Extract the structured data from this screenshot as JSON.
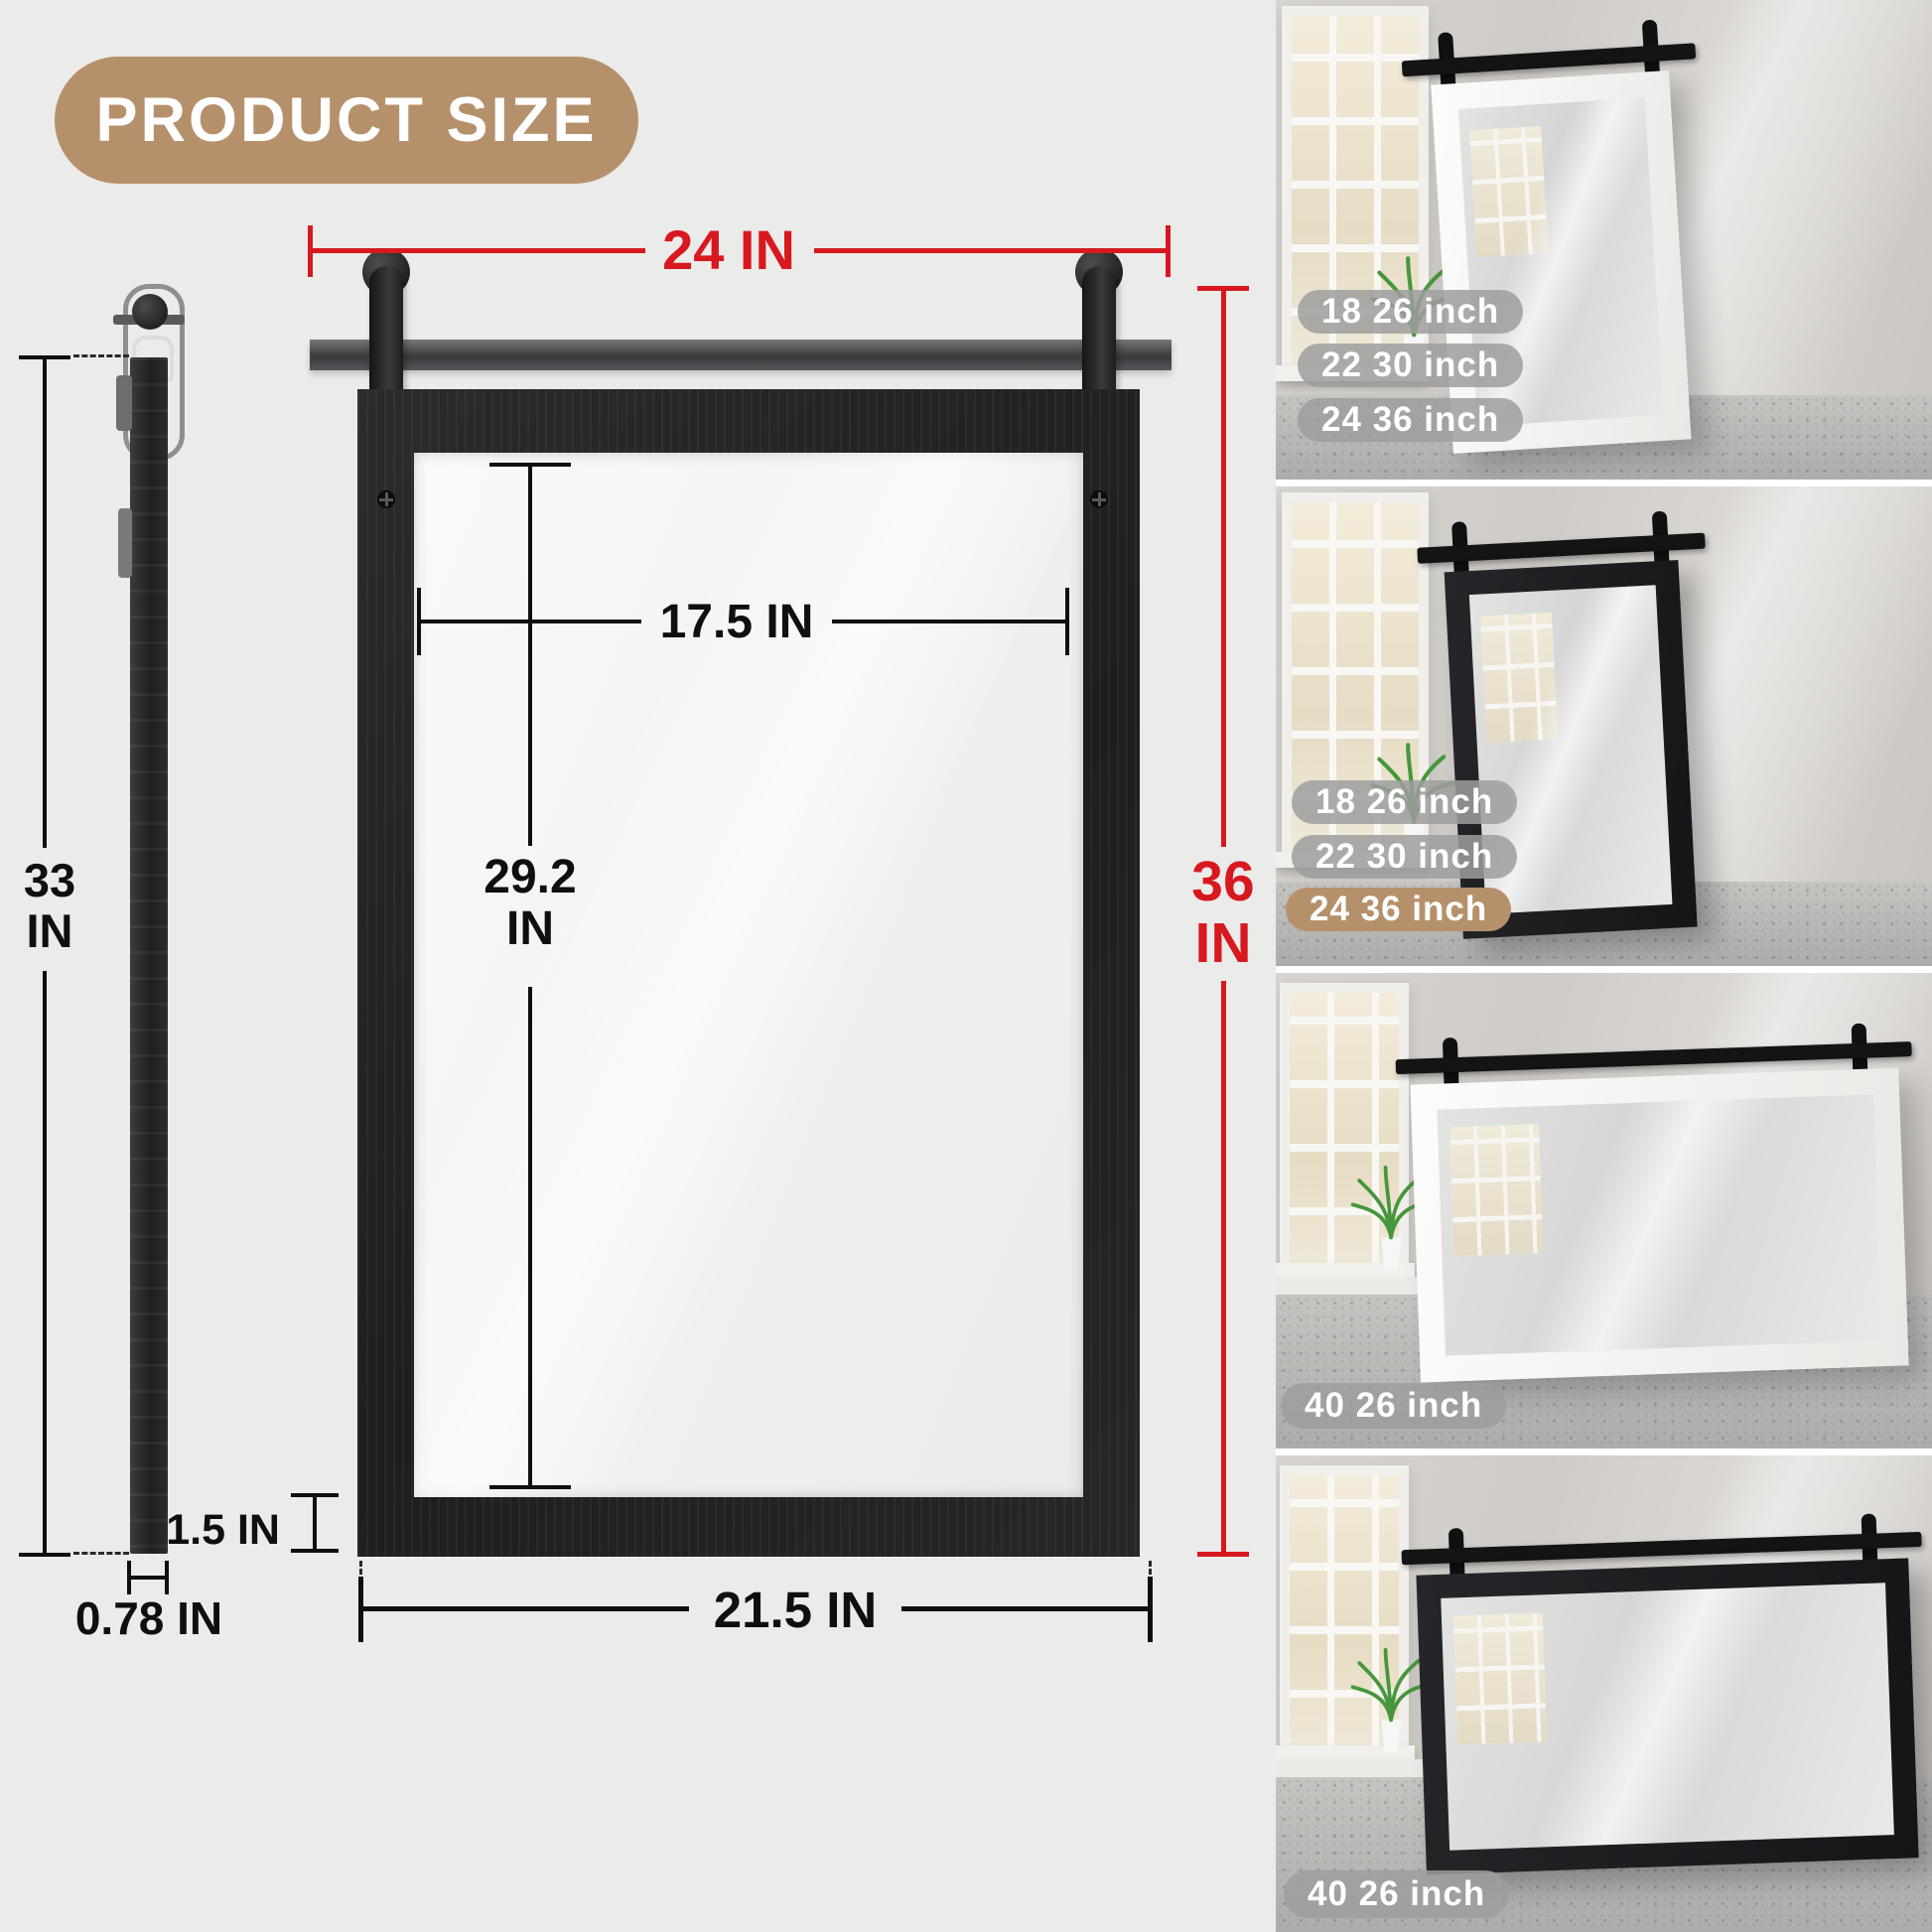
{
  "badge": {
    "label": "PRODUCT SIZE"
  },
  "colors": {
    "accent_red": "#d7191f",
    "badge_tan": "#b5916b",
    "pill_gray": "#9d9d9d",
    "frame_black": "#1d1e20",
    "background": "#ebebea"
  },
  "front_view": {
    "overall_width": "24 IN",
    "overall_height_value": "36",
    "overall_height_unit": "IN",
    "inner_width": "17.5 IN",
    "inner_height_value": "29.2",
    "inner_height_unit": "IN",
    "frame_thickness": "1.5 IN",
    "bottom_width": "21.5 IN"
  },
  "side_view": {
    "height_value": "33",
    "height_unit": "IN",
    "depth": "0.78 IN"
  },
  "photos": [
    {
      "variant": "white-portrait-mirror",
      "labels": [
        {
          "text": "18 26 inch"
        },
        {
          "text": "22 30 inch"
        },
        {
          "text": "24 36 inch"
        }
      ]
    },
    {
      "variant": "black-portrait-mirror",
      "labels": [
        {
          "text": "18 26 inch"
        },
        {
          "text": "22 30 inch"
        },
        {
          "text": "24 36 inch"
        }
      ]
    },
    {
      "variant": "white-landscape-mirror",
      "labels": [
        {
          "text": "40 26 inch"
        }
      ]
    },
    {
      "variant": "black-landscape-mirror",
      "labels": [
        {
          "text": "40 26 inch"
        }
      ]
    }
  ]
}
